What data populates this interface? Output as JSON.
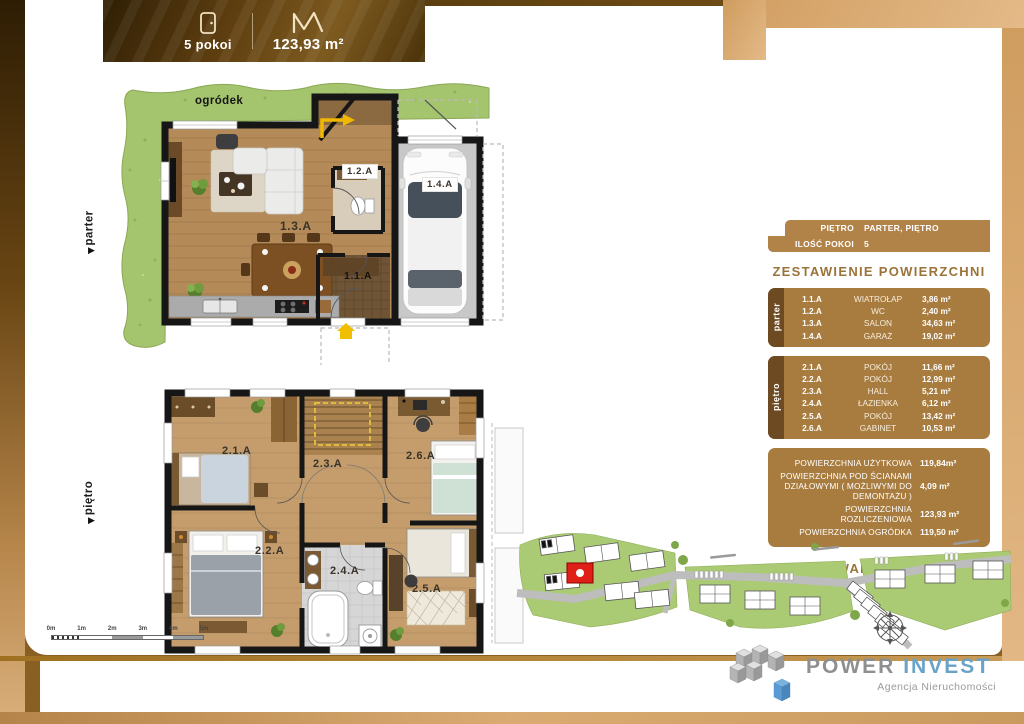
{
  "header": {
    "rooms_label": "5 pokoi",
    "area_label": "123,93 m²"
  },
  "floor_markers": {
    "ground": "parter",
    "upper": "piętro"
  },
  "ground_plan": {
    "garden_label": "ogródek",
    "room_ids": {
      "wiatrolap": "1.1.A",
      "wc": "1.2.A",
      "salon": "1.3.A",
      "garaz": "1.4.A"
    }
  },
  "upper_plan": {
    "room_ids": {
      "pokoj_1": "2.1.A",
      "pokoj_2": "2.2.A",
      "hall": "2.3.A",
      "lazienka": "2.4.A",
      "pokoj_3": "2.5.A",
      "gabinet": "2.6.A"
    }
  },
  "scale_bar": {
    "ticks": [
      "0m",
      "1m",
      "2m",
      "3m",
      "4m",
      "5m"
    ]
  },
  "info_table": {
    "meta": [
      {
        "label": "PIĘTRO",
        "value": "PARTER, PIĘTRO"
      },
      {
        "label": "ILOŚĆ POKOI",
        "value": "5"
      }
    ],
    "title": "ZESTAWIENIE POWIERZCHNI",
    "sections": [
      {
        "tab": "parter",
        "rows": [
          {
            "code": "1.1.A",
            "name": "WIATROŁAP",
            "area": "3,86 m²"
          },
          {
            "code": "1.2.A",
            "name": "WC",
            "area": "2,40 m²"
          },
          {
            "code": "1.3.A",
            "name": "SALON",
            "area": "34,63 m²"
          },
          {
            "code": "1.4.A",
            "name": "GARAŻ",
            "area": "19,02 m²"
          }
        ]
      },
      {
        "tab": "piętro",
        "rows": [
          {
            "code": "2.1.A",
            "name": "POKÓJ",
            "area": "11,66 m²"
          },
          {
            "code": "2.2.A",
            "name": "POKÓJ",
            "area": "12,99 m²"
          },
          {
            "code": "2.3.A",
            "name": "HALL",
            "area": "5,21 m²"
          },
          {
            "code": "2.4.A",
            "name": "ŁAZIENKA",
            "area": "6,12 m²"
          },
          {
            "code": "2.5.A",
            "name": "POKÓJ",
            "area": "13,42 m²"
          },
          {
            "code": "2.6.A",
            "name": "GABINET",
            "area": "10,53 m²"
          }
        ]
      }
    ],
    "summary": [
      {
        "label": "POWIERZCHNIA UŻYTKOWA",
        "value": "119,84m²"
      },
      {
        "label": "POWIERZCHNIA POD ŚCIANAMI DZIAŁOWYMI ( MOŻLIWYMI DO DEMONTAŻU )",
        "value": "4,09 m²"
      },
      {
        "label": "POWIERZCHNIA ROZLICZENIOWA",
        "value": "123,93 m²"
      },
      {
        "label": "POWIERZCHNIA OGRÓDKA",
        "value": "119,50 m²"
      }
    ],
    "site_title": "USYTUOWANIE NA OSIEDLU"
  },
  "footer": {
    "brand_first": "POWER",
    "brand_second": "INVEST",
    "tagline": "Agencja Nieruchomości"
  },
  "colors": {
    "accent_gold": "#a87c3f",
    "accent_dark_gold": "#6d4a21",
    "frame_tan": "#d8a96e",
    "header_brown": "#5a3c0e",
    "highlight_unit_red": "#e02018",
    "brand_gray": "#8f8f8f",
    "brand_blue": "#6aa3c7",
    "grass_green": "#a4c46d"
  }
}
